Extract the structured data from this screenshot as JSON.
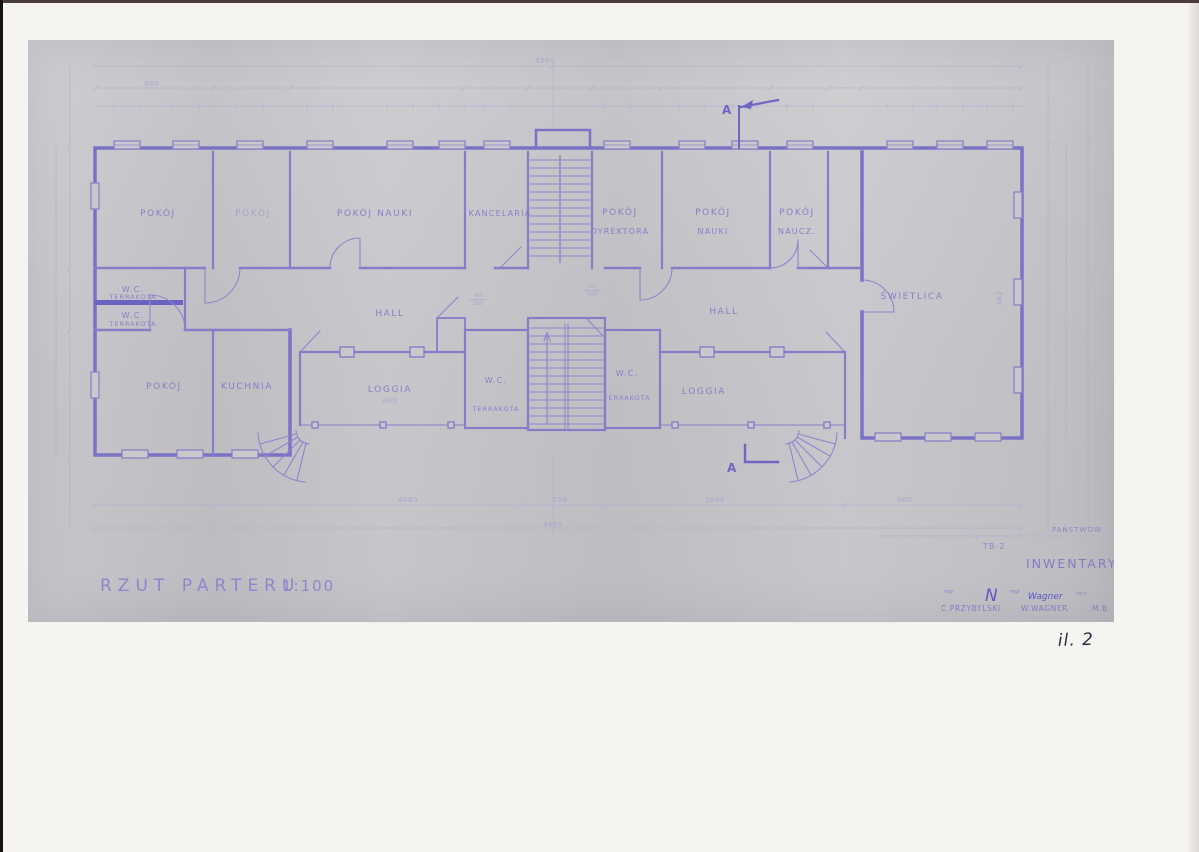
{
  "colors": {
    "ink": "#7b74c4",
    "paper": "#c9c8cc",
    "annotation_ink": "#2f2b3a"
  },
  "sheet": {
    "title": "RZUT PARTERU",
    "scale": "1:100",
    "section_marker": "A",
    "stamp": {
      "office": "PAŃSTWOW",
      "sheet_no": "TB-2",
      "heading": "INWENTARYZAC",
      "role_1": "mgr",
      "monogram": "N",
      "role_2": "mgr",
      "hand_note": "Wagner",
      "role_3": "tech",
      "name_1": "C.PRZYBYLSKI",
      "name_2": "W.WAGNER",
      "name_3": "M.B"
    }
  },
  "annotation": {
    "figure_no": "il. 2"
  },
  "rooms": {
    "pokoj_1": "POKÓJ",
    "pokoj_2": "POKÓJ",
    "pokoj_nauki_a": "POKÓJ NAUKI",
    "kancelaria": "KANCELARIA",
    "pokoj_dyrektora_1": "POKÓJ",
    "pokoj_dyrektora_2": "DYREKTORA",
    "pokoj_nauki_b1": "POKÓJ",
    "pokoj_nauki_b2": "NAUKI",
    "pokoj_naucz_1": "POKÓJ",
    "pokoj_naucz_2": "NAUCZ.",
    "swietlica": "ŚWIETLICA",
    "wc_a1": "W.C.",
    "wc_a2": "TERRAKOTA",
    "wc_b1": "W.C.",
    "wc_b2": "TERRAKOTA",
    "hall_left": "HALL",
    "hall_right": "HALL",
    "pokoj_3": "POKÓJ",
    "kuchnia": "KUCHNIA",
    "loggia_left": "LOGGIA",
    "wc_c1": "W.C.",
    "wc_c2": "TERRAKOTA",
    "wc_d1": "W.C.",
    "wc_d2": "TERRAKOTA",
    "loggia_right": "LOGGIA"
  },
  "dimensions": {
    "top_total": "4560",
    "seg_680": "680",
    "bottom_1": "4080",
    "bottom_2": "756",
    "bottom_3": "1088",
    "bottom_4": "800",
    "bottom_total": "4450",
    "loggia_width": "800",
    "right_interior": "462",
    "door_w": "90",
    "door_h": "205"
  }
}
